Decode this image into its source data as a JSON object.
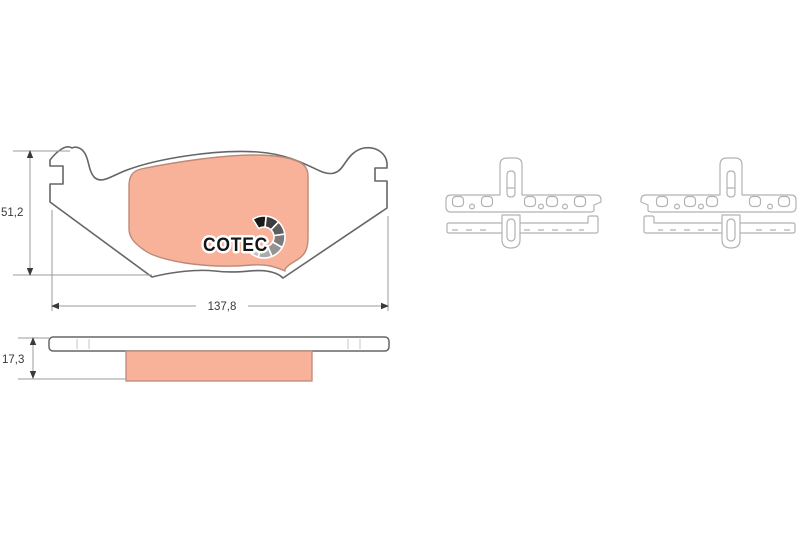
{
  "page": {
    "background": "#ffffff"
  },
  "drawing": {
    "logo": {
      "text": "COTEC",
      "text_color": "#151515",
      "segment_colors": [
        "#1a1a1a",
        "#3c3c3c",
        "#5c5c5c",
        "#7b7b7b",
        "#949494",
        "#ababab",
        "#c4c4c4",
        "#dadada"
      ]
    },
    "dimensions": {
      "height_label": "51,2",
      "width_label": "137,8",
      "thickness_label": "17,3"
    },
    "colors": {
      "friction_fill": "#f8b29a",
      "friction_stroke": "#bd8a77",
      "plate_stroke": "#666666",
      "shim_stroke": "#b2b2b2",
      "tick_gray": "#c4c4c4",
      "dim_line": "#9b9b9b",
      "dim_text": "#3a3a3a"
    }
  }
}
